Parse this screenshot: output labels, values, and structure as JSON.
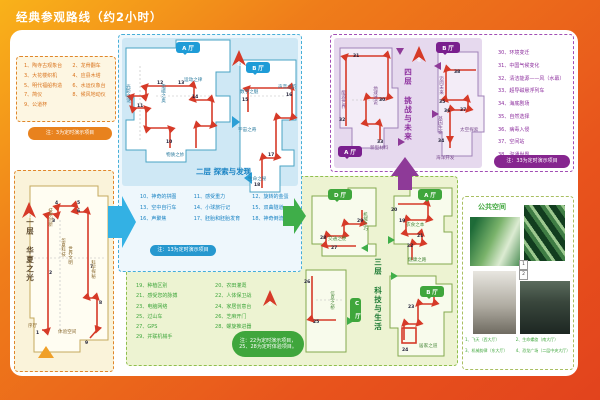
{
  "title": "经典参观路线（约2小时）",
  "compass": "北",
  "floor1": {
    "name": "一层 华夏之光",
    "list": [
      "1、陶寺古观象台",
      "2、龙骨翻车",
      "3、大花楼织机",
      "4、应县木塔",
      "5、明代福船构造",
      "6、水运仪象台",
      "7、简仪",
      "8、候风地动仪",
      "9、公道杯"
    ],
    "note": "注：3为定时演示项目",
    "stops": [
      "1",
      "2",
      "3",
      "4",
      "5",
      "6",
      "7",
      "8",
      "9"
    ],
    "areas": [
      "技术创新",
      "科学探秘",
      "华夏科技",
      "世界文明",
      "序厅",
      "体验空间"
    ]
  },
  "floor2": {
    "name": "二层 探索与发现",
    "halls": [
      "A 厅",
      "B 厅"
    ],
    "list": [
      "10、神奇的拼图",
      "11、感受重力",
      "12、旋转的金蛋",
      "13、空中自行车",
      "14、小球旅行记",
      "15、双曲隧道",
      "16、声聚焦",
      "17、胚胎和胚胎发育",
      "18、神奇倒流"
    ],
    "note": "注：13为定时演示项目",
    "stops": [
      "10",
      "11",
      "12",
      "13",
      "14",
      "15",
      "16",
      "17",
      "18"
    ],
    "areas": [
      "光影之谜",
      "电磁之奥",
      "运动之律",
      "宇宙之奇",
      "物质之妙",
      "数学之魅",
      "声音之韵",
      "生命之秘"
    ]
  },
  "floor3": {
    "name": "三层 科技与生活",
    "halls": [
      "D 厅",
      "A 厅",
      "C 厅",
      "B 厅"
    ],
    "list": [
      "19、种植区别",
      "20、农田灌溉",
      "21、感受您的脉搏",
      "22、人体保卫战",
      "23、电脑网络",
      "24、家居创意台",
      "25、过山车",
      "26、芝麻开门",
      "27、GPS",
      "28、螺旋推进器",
      "29、并联机械手"
    ],
    "note1": "注：22为定时演示项目，",
    "note2": "25、28为定时体验项目。",
    "stops": [
      "19",
      "20",
      "21",
      "22",
      "23",
      "24",
      "25",
      "26",
      "27",
      "28",
      "29"
    ],
    "areas": [
      "交通之便",
      "机械之巧",
      "衣食之本",
      "健康之路",
      "信息之桥",
      "居家之道"
    ]
  },
  "floor4": {
    "name": "四层 挑战与未来",
    "halls": [
      "A 厅",
      "B 厅"
    ],
    "list": [
      "30、环境变迁",
      "31、中国气候变化",
      "32、清洁能源——风（水幕）",
      "33、超导磁悬浮列车",
      "34、海底剧场",
      "35、自然选择",
      "36、病毒入侵",
      "37、空间站",
      "38、沟通世界"
    ],
    "note": "注：33为定时演示项目",
    "stops": [
      "30",
      "31",
      "32",
      "33",
      "34",
      "35",
      "36",
      "37",
      "38"
    ],
    "areas": [
      "能源世界",
      "地球述说",
      "新型材料",
      "迈向未来",
      "基因生命",
      "太空探索",
      "海洋开发"
    ]
  },
  "public_space": {
    "title": "公共空间",
    "captions": [
      "1、飞天（西大厅）",
      "2、生命螺旋（南大厅）",
      "3、机械韵律（东大厅）",
      "4、恐龙广场（二层中央大厅）"
    ],
    "tags": [
      "1",
      "2"
    ]
  }
}
